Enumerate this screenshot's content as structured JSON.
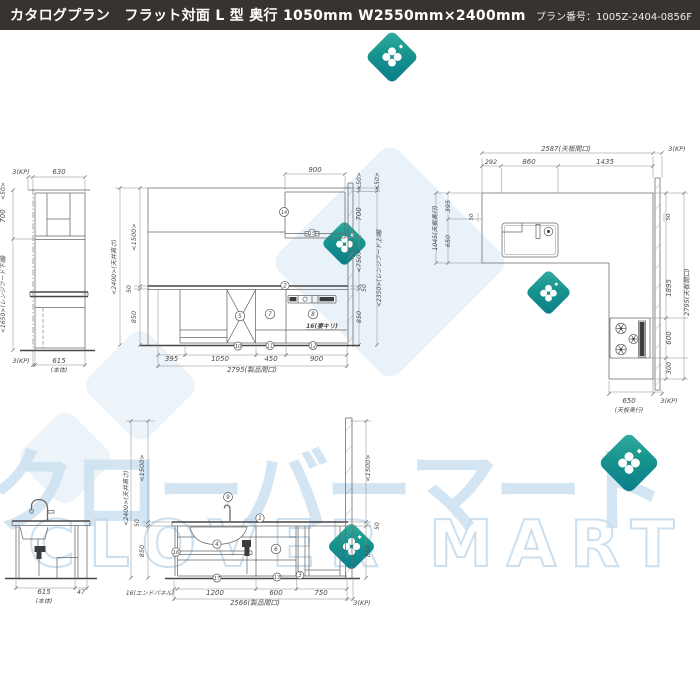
{
  "header": {
    "title": "カタログプラン　フラット対面 L 型 奥行 1050mm W2550mm×2400mm",
    "plan_number": "プラン番号：1005Z-2404-0856F"
  },
  "watermark": {
    "katakana": "クローバーマート",
    "latin": "CLOVER MART"
  },
  "colors": {
    "header_bg": "#393330",
    "header_fg": "#ffffff",
    "line_gray": "#6a6a6a",
    "dim_text_gray": "#4a4a4a",
    "watermark_blue": "#c9dff0",
    "clover_teal_light": "#35aca1",
    "clover_teal_dark": "#0b7c8b"
  },
  "drawing": {
    "annotations": [
      {
        "t": "3(KP)",
        "x": 21,
        "y": 174,
        "s": 6.5
      },
      {
        "t": "630",
        "x": 59,
        "y": 174
      },
      {
        "t": "<50>",
        "x": 5,
        "y": 191,
        "r": -90,
        "s": 6
      },
      {
        "t": "700",
        "x": 5,
        "y": 216,
        "r": -90
      },
      {
        "t": "<1650>(レンジフード下端)",
        "x": 5,
        "y": 294,
        "r": -90,
        "s": 6
      },
      {
        "t": "3(KP)",
        "x": 21,
        "y": 363,
        "s": 6.5
      },
      {
        "t": "615",
        "x": 59,
        "y": 363
      },
      {
        "t": "(本体)",
        "x": 59,
        "y": 372,
        "s": 6
      },
      {
        "t": "<2400>(天井高さ)",
        "x": 116,
        "y": 267,
        "r": -90,
        "s": 6.2
      },
      {
        "t": "<1500>",
        "x": 136,
        "y": 237,
        "r": -90,
        "s": 6.5
      },
      {
        "t": "50",
        "x": 131,
        "y": 289,
        "r": -90,
        "s": 6
      },
      {
        "t": "850",
        "x": 136,
        "y": 317,
        "r": -90,
        "s": 6.5
      },
      {
        "t": "900",
        "x": 315,
        "y": 172
      },
      {
        "t": "395",
        "x": 171.5,
        "y": 361
      },
      {
        "t": "1050",
        "x": 220,
        "y": 361
      },
      {
        "t": "450",
        "x": 271,
        "y": 361
      },
      {
        "t": "900",
        "x": 316.5,
        "y": 361
      },
      {
        "t": "2795(製品間口)",
        "x": 252,
        "y": 372,
        "s": 6.8
      },
      {
        "t": "16(妻キリ)",
        "x": 322,
        "y": 328,
        "s": 6,
        "b": true
      },
      {
        "t": "<50>",
        "x": 361,
        "y": 181,
        "r": -90,
        "s": 6
      },
      {
        "t": "700",
        "x": 361,
        "y": 214,
        "r": -90
      },
      {
        "t": "<750>",
        "x": 361,
        "y": 261,
        "r": -90,
        "s": 6.5
      },
      {
        "t": "50",
        "x": 366,
        "y": 288,
        "r": -90,
        "s": 6
      },
      {
        "t": "850",
        "x": 361,
        "y": 317,
        "r": -90,
        "s": 6.5
      },
      {
        "t": "<50>",
        "x": 379,
        "y": 181,
        "r": -90,
        "s": 6
      },
      {
        "t": "<2350>(レンジフード上端)",
        "x": 381,
        "y": 268,
        "r": -90,
        "s": 6
      },
      {
        "t": "2587(天板間口)",
        "x": 566,
        "y": 151,
        "s": 6.8
      },
      {
        "t": "3(KP)",
        "x": 677,
        "y": 151,
        "s": 6.5
      },
      {
        "t": "292",
        "x": 491,
        "y": 164,
        "s": 6.5
      },
      {
        "t": "860",
        "x": 529,
        "y": 164
      },
      {
        "t": "1435",
        "x": 605,
        "y": 164
      },
      {
        "t": "1045(天板奥行)",
        "x": 437,
        "y": 228,
        "r": -90,
        "s": 6.2
      },
      {
        "t": "395",
        "x": 450,
        "y": 206,
        "r": -90,
        "s": 6.5
      },
      {
        "t": "650",
        "x": 450,
        "y": 241,
        "r": -90,
        "s": 6.5
      },
      {
        "t": "50",
        "x": 473,
        "y": 217,
        "r": -90,
        "s": 5.5
      },
      {
        "t": "50",
        "x": 670,
        "y": 217,
        "r": -90,
        "s": 5.5
      },
      {
        "t": "1895",
        "x": 671,
        "y": 288,
        "r": -90
      },
      {
        "t": "600",
        "x": 671,
        "y": 338,
        "r": -90
      },
      {
        "t": "300",
        "x": 671,
        "y": 368,
        "r": -90,
        "s": 6.5
      },
      {
        "t": "2795(天板間口)",
        "x": 689,
        "y": 292,
        "r": -90,
        "s": 6.5
      },
      {
        "t": "650",
        "x": 629,
        "y": 403
      },
      {
        "t": "(天板奥行)",
        "x": 629,
        "y": 412,
        "s": 6
      },
      {
        "t": "3(KP)",
        "x": 669,
        "y": 403,
        "s": 6.5
      },
      {
        "t": "615",
        "x": 44,
        "y": 594
      },
      {
        "t": "(本体)",
        "x": 44,
        "y": 603,
        "s": 6
      },
      {
        "t": "47",
        "x": 81,
        "y": 594,
        "s": 6.5
      },
      {
        "t": "<2400>(天井高さ)",
        "x": 128,
        "y": 498,
        "r": -90,
        "s": 6.2
      },
      {
        "t": "<1500>",
        "x": 144,
        "y": 468,
        "r": -90,
        "s": 6.5
      },
      {
        "t": "50",
        "x": 139,
        "y": 523,
        "r": -90,
        "s": 6
      },
      {
        "t": "850",
        "x": 144,
        "y": 551,
        "r": -90,
        "s": 6.5
      },
      {
        "t": "16(エンドパネル)",
        "x": 150,
        "y": 595,
        "s": 6
      },
      {
        "t": "1200",
        "x": 215,
        "y": 595
      },
      {
        "t": "600",
        "x": 276,
        "y": 595
      },
      {
        "t": "750",
        "x": 321,
        "y": 595
      },
      {
        "t": "2566(製品間口)",
        "x": 255,
        "y": 605,
        "s": 6.8
      },
      {
        "t": "3(KP)",
        "x": 362,
        "y": 605,
        "s": 6.5
      },
      {
        "t": "<1500>",
        "x": 370,
        "y": 468,
        "r": -90,
        "s": 6.5
      },
      {
        "t": "50",
        "x": 379,
        "y": 526,
        "r": -90,
        "s": 6
      },
      {
        "t": "850",
        "x": 370,
        "y": 551,
        "r": -90,
        "s": 6.5
      }
    ],
    "callouts": [
      {
        "n": "14",
        "x": 284,
        "y": 212,
        "r": 4.5
      },
      {
        "n": "15",
        "x": 312,
        "y": 233,
        "r": 3.8
      },
      {
        "n": "2",
        "x": 285,
        "y": 285.5,
        "r": 4.2
      },
      {
        "n": "5",
        "x": 240,
        "y": 316,
        "r": 4.8
      },
      {
        "n": "7",
        "x": 270,
        "y": 314,
        "r": 4.8
      },
      {
        "n": "8",
        "x": 313,
        "y": 314,
        "r": 4.8
      },
      {
        "n": "10",
        "x": 238,
        "y": 346,
        "r": 4
      },
      {
        "n": "11",
        "x": 270,
        "y": 345.5,
        "r": 4
      },
      {
        "n": "12",
        "x": 313,
        "y": 345.5,
        "r": 4
      },
      {
        "n": "9",
        "x": 228,
        "y": 497,
        "r": 4.5
      },
      {
        "n": "1",
        "x": 260,
        "y": 518,
        "r": 4.2
      },
      {
        "n": "4",
        "x": 217,
        "y": 544,
        "r": 4.2
      },
      {
        "n": "16",
        "x": 176,
        "y": 552,
        "r": 4.2
      },
      {
        "n": "6",
        "x": 276,
        "y": 549,
        "r": 4.8
      },
      {
        "n": "17",
        "x": 217,
        "y": 578,
        "r": 4
      },
      {
        "n": "13",
        "x": 277,
        "y": 577,
        "r": 4
      },
      {
        "n": "3",
        "x": 300,
        "y": 575,
        "r": 3.8
      }
    ]
  }
}
